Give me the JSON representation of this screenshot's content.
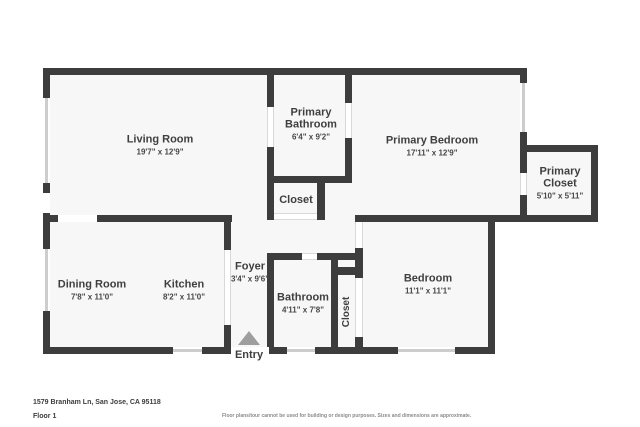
{
  "rooms": {
    "living": {
      "name": "Living Room",
      "dims": "19'7\" x 12'9\""
    },
    "primary_bathroom": {
      "name": "Primary Bathroom",
      "dims": "6'4\" x 9'2\""
    },
    "primary_bedroom": {
      "name": "Primary Bedroom",
      "dims": "17'11\" x 12'9\""
    },
    "primary_closet": {
      "name": "Primary Closet",
      "dims": "5'10\" x 5'11\""
    },
    "hall_closet": {
      "name": "Closet"
    },
    "dining": {
      "name": "Dining Room",
      "dims": "7'8\" x 11'0\""
    },
    "kitchen": {
      "name": "Kitchen",
      "dims": "8'2\" x 11'0\""
    },
    "foyer": {
      "name": "Foyer",
      "dims": "3'4\" x 9'6\""
    },
    "bathroom": {
      "name": "Bathroom",
      "dims": "4'11\" x 7'8\""
    },
    "bedroom_closet": {
      "name": "Closet"
    },
    "bedroom": {
      "name": "Bedroom",
      "dims": "11'1\" x 11'1\""
    }
  },
  "entry": {
    "label": "Entry"
  },
  "footer": {
    "address": "1579 Branham Ln, San Jose, CA 95118",
    "floor": "Floor 1",
    "disclaimer": "Floor plans/tour cannot be used for building or design purposes. Sizes and dimensions are approximate."
  },
  "colors": {
    "wall": "#3d3d3d",
    "floor": "#f7f7f7",
    "window": "#cdcdcd",
    "label": "#3f3f3f",
    "entry_arrow": "#9e9e9e"
  }
}
